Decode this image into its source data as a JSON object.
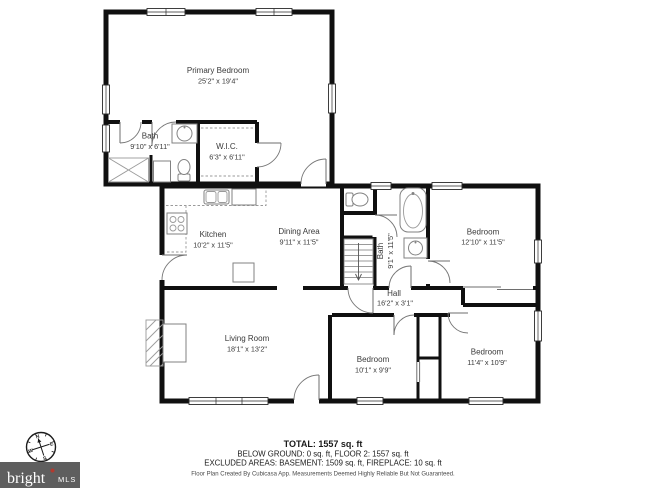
{
  "branding": {
    "logo_main": "bright",
    "logo_sub": "MLS",
    "compass": {
      "n": "N",
      "e": "E",
      "s": "S",
      "w": "W"
    },
    "logo_bg": "#5e5e5e",
    "logo_accent": "#b23a2f"
  },
  "rooms": [
    {
      "name": "Primary Bedroom",
      "dims": "25'2\" x 19'4\""
    },
    {
      "name": "Bath",
      "dims": "9'10\" x 6'11\""
    },
    {
      "name": "W.I.C.",
      "dims": "6'3\" x 6'11\""
    },
    {
      "name": "Kitchen",
      "dims": "10'2\" x 11'5\""
    },
    {
      "name": "Dining Area",
      "dims": "9'11\" x 11'5\""
    },
    {
      "name": "Bath",
      "dims": "9'1\" x 11'5\""
    },
    {
      "name": "Bedroom",
      "dims": "12'10\" x 11'5\""
    },
    {
      "name": "Hall",
      "dims": "16'2\" x 3'1\""
    },
    {
      "name": "Living Room",
      "dims": "18'1\" x 13'2\""
    },
    {
      "name": "Bedroom",
      "dims": "10'1\" x 9'9\""
    },
    {
      "name": "Bedroom",
      "dims": "11'4\" x 10'9\""
    }
  ],
  "summary": {
    "total": "TOTAL: 1557 sq. ft",
    "floors": "BELOW GROUND: 0 sq. ft, FLOOR 2: 1557 sq. ft",
    "excluded": "EXCLUDED AREAS: BASEMENT: 1509 sq. ft, FIREPLACE: 10 sq. ft",
    "disclaimer": "Floor Plan Created By Cubicasa App. Measurements Deemed Highly Reliable But Not Guaranteed."
  }
}
